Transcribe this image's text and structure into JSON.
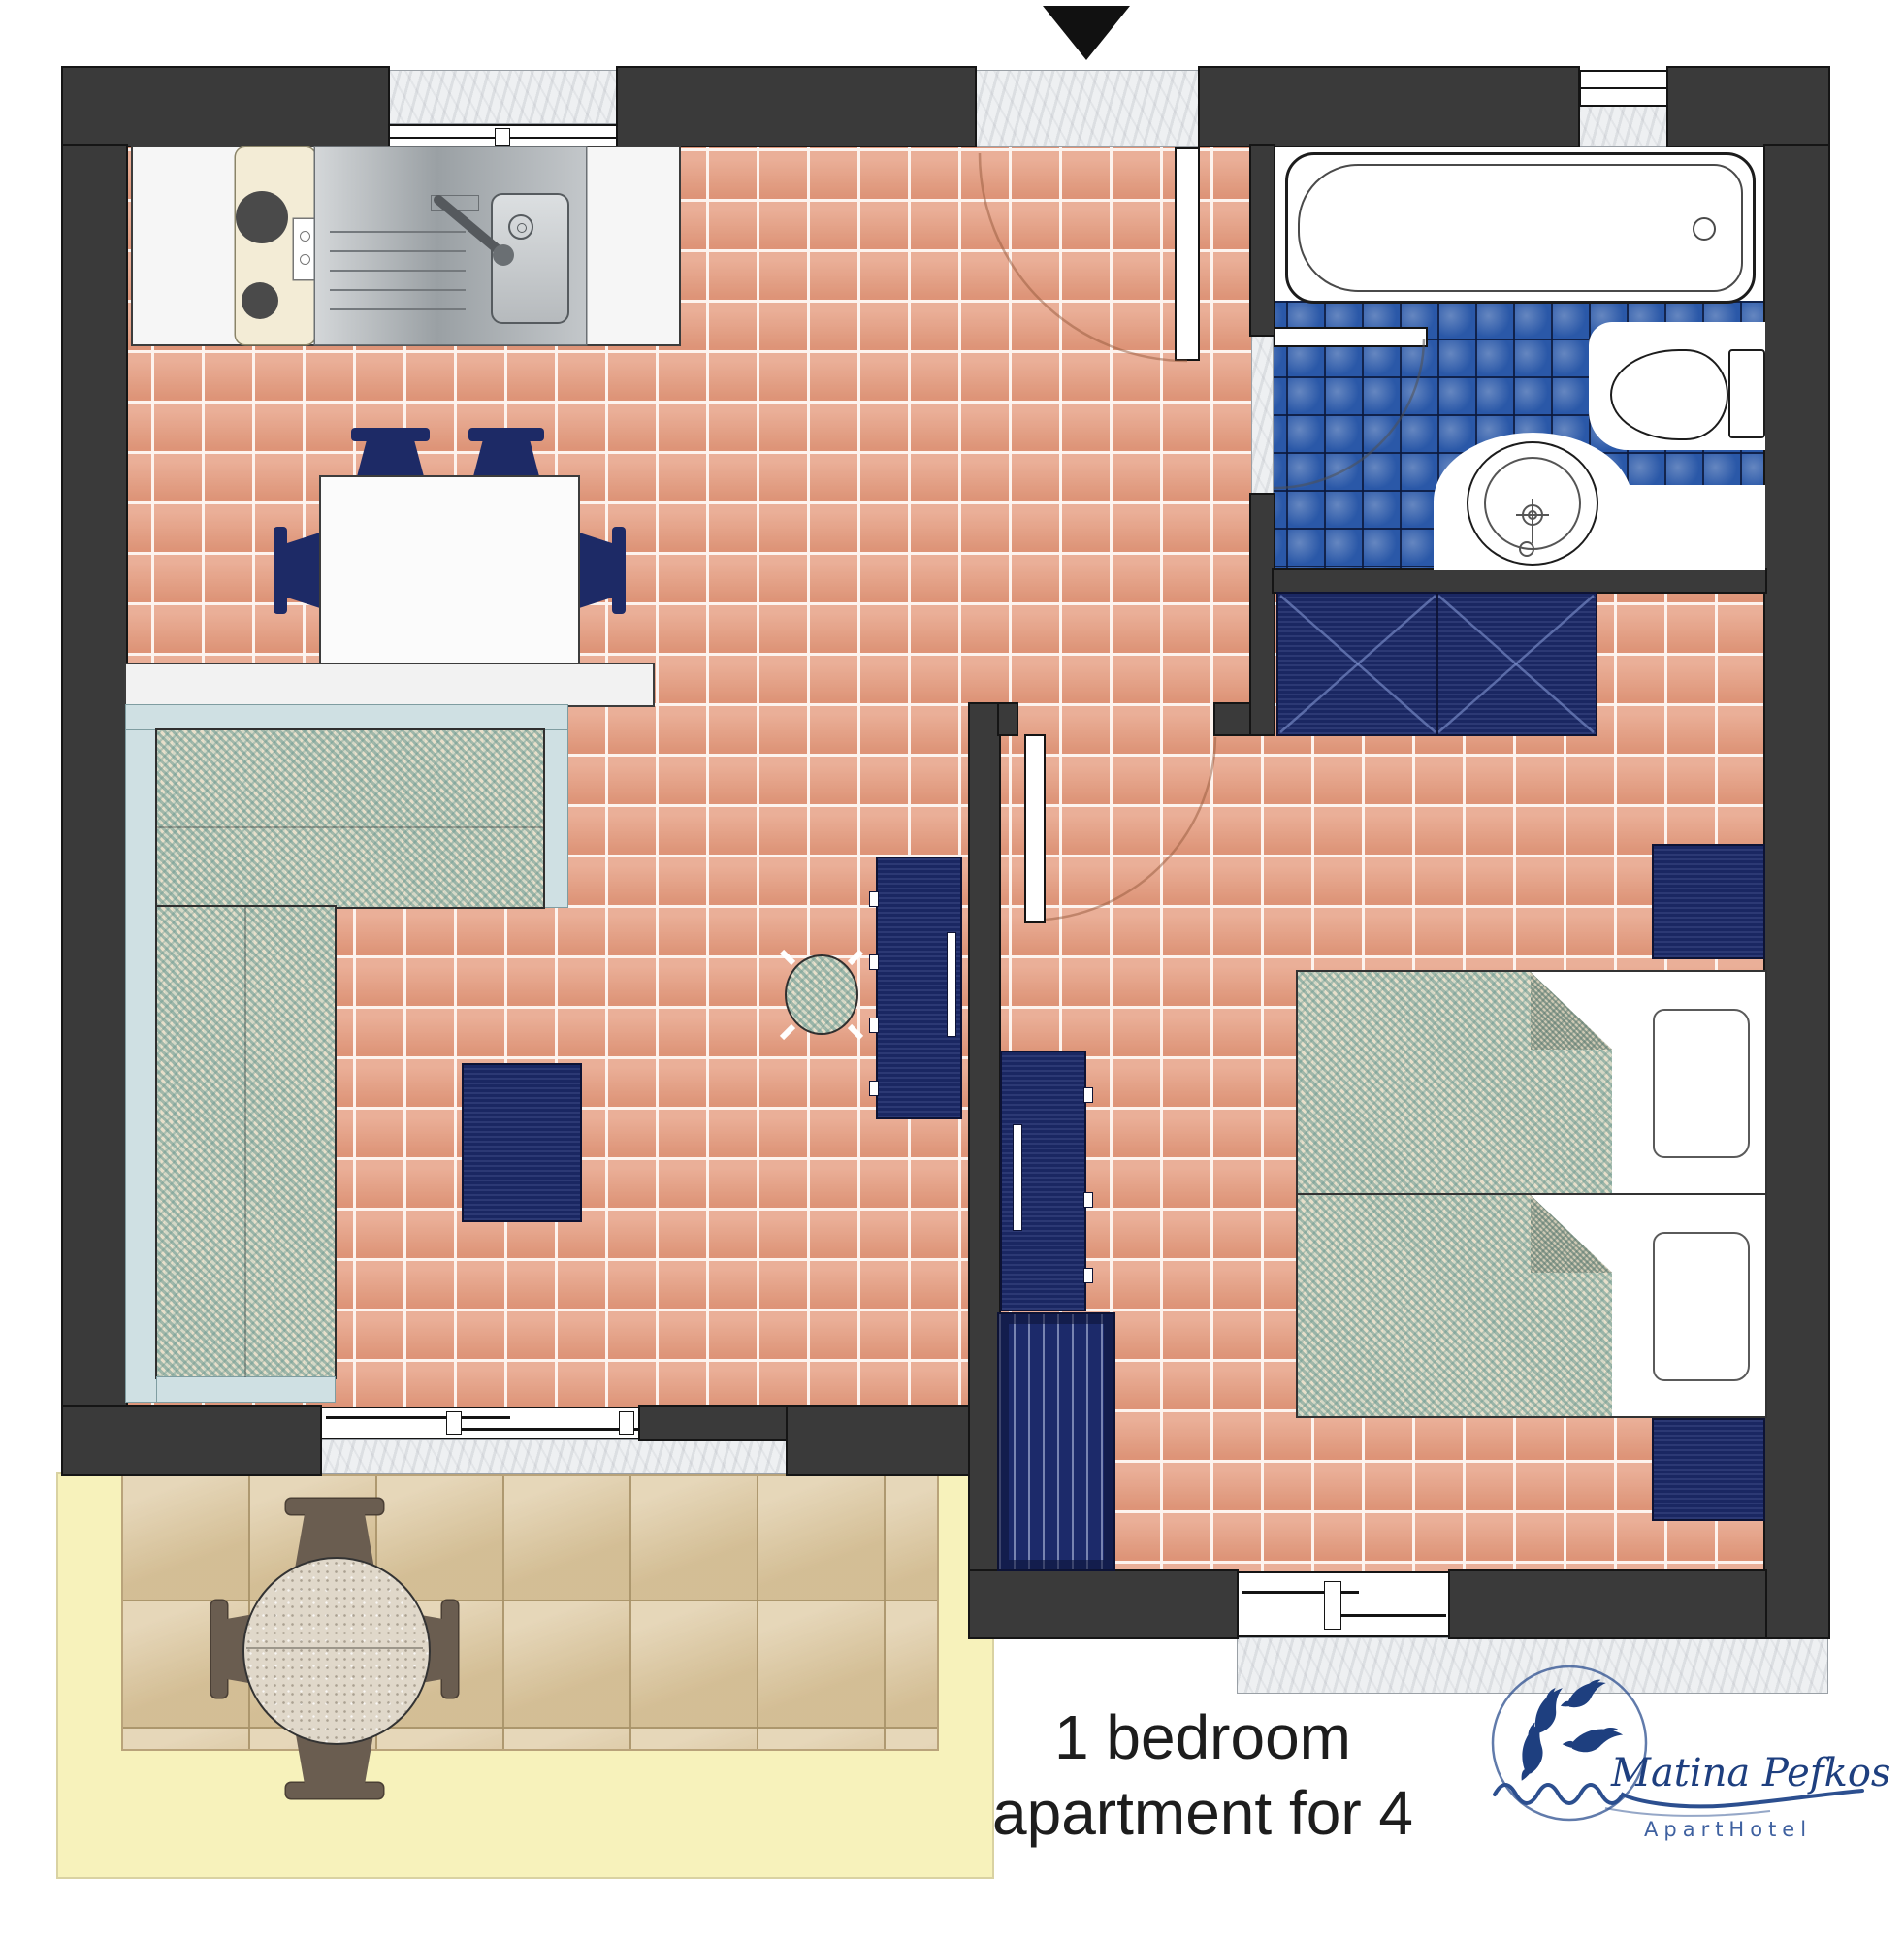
{
  "title": {
    "line1": "1 bedroom",
    "line2": "apartment for 4"
  },
  "logo": {
    "name": "Matina Pefkos",
    "subtitle": "ApartHotel"
  },
  "entrance": {
    "marker_icon": "entrance-arrow"
  },
  "plan_elements": {
    "rooms": [
      "kitchen-living-dining area",
      "bathroom",
      "bedroom",
      "terrace"
    ],
    "kitchen": [
      "two-burner stove",
      "stainless sink with faucet",
      "white counter"
    ],
    "living": [
      "dining table with 4 chairs",
      "wall shelf",
      "L-shaped houndstooth sofa",
      "coffee table",
      "round stool",
      "tv cabinet"
    ],
    "bathroom": [
      "bathtub",
      "toilet",
      "wash basin",
      "open door",
      "blue tile floor"
    ],
    "bedroom": [
      "wardrobe with X doors",
      "2 nightstands",
      "2 twin beds with houndstooth covers and pillows",
      "dresser cabinet",
      "luggage bench"
    ],
    "terrace": [
      "round granite table",
      "4 brown chairs",
      "tan tile floor",
      "pale yellow border"
    ]
  },
  "colors": {
    "wall": "#3a3a3a",
    "terracotta_tile": "#e59b7e",
    "bath_tile_blue": "#2a58a8",
    "terrace_tile": "#dcc79e",
    "terrace_border": "#f7f2bb",
    "furniture_navy": "#1c2a6a",
    "sofa_frame": "#cfe0e3",
    "fabric_teal": "#6896 8e",
    "logo_navy": "#27497f",
    "marble": "#eef0f2"
  }
}
